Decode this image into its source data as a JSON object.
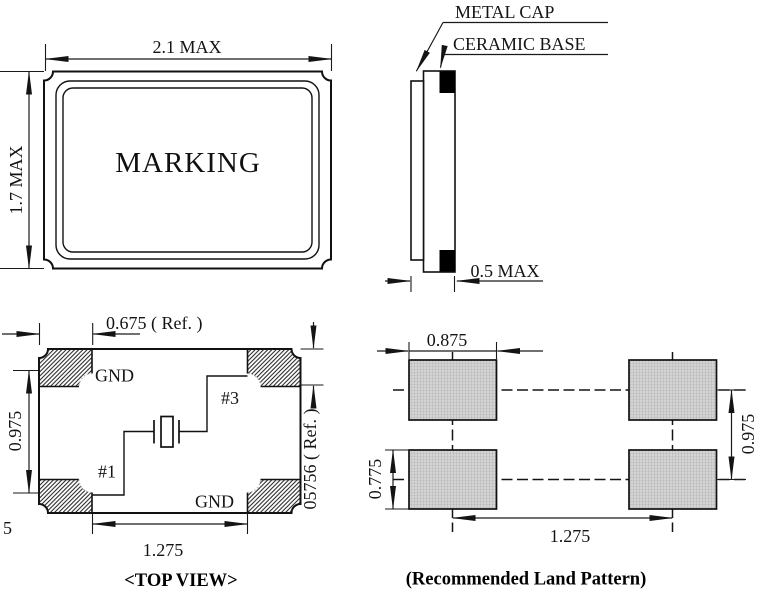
{
  "front_view": {
    "marking": "MARKING",
    "dim_width": "2.1 MAX",
    "dim_height": "1.7 MAX"
  },
  "side_view": {
    "metal_cap_label": "METAL CAP",
    "ceramic_base_label": "CERAMIC BASE",
    "dim_thickness": "0.5 MAX"
  },
  "top_view": {
    "caption": "<TOP VIEW>",
    "pads": {
      "top_left": "GND",
      "top_right": "#3",
      "bottom_left": "#1",
      "bottom_right": "GND"
    },
    "dim_pad_width": "0.675 ( Ref. )",
    "dim_vertical_pitch": "0.975",
    "dim_horizontal_pitch": "1.275",
    "dim_pad_height": "05756 ( Ref. )",
    "stray_digit": "5"
  },
  "land_pattern": {
    "caption": "(Recommended Land Pattern)",
    "dim_pad_width": "0.875",
    "dim_pad_height": "0.775",
    "dim_vertical_pitch": "0.975",
    "dim_horizontal_pitch": "1.275"
  },
  "colors": {
    "line": "#1a1a1a",
    "pad_fill": "#d4d4d4",
    "pad_grid": "#a3a3a3",
    "electrode": "#000000",
    "background": "#ffffff"
  }
}
